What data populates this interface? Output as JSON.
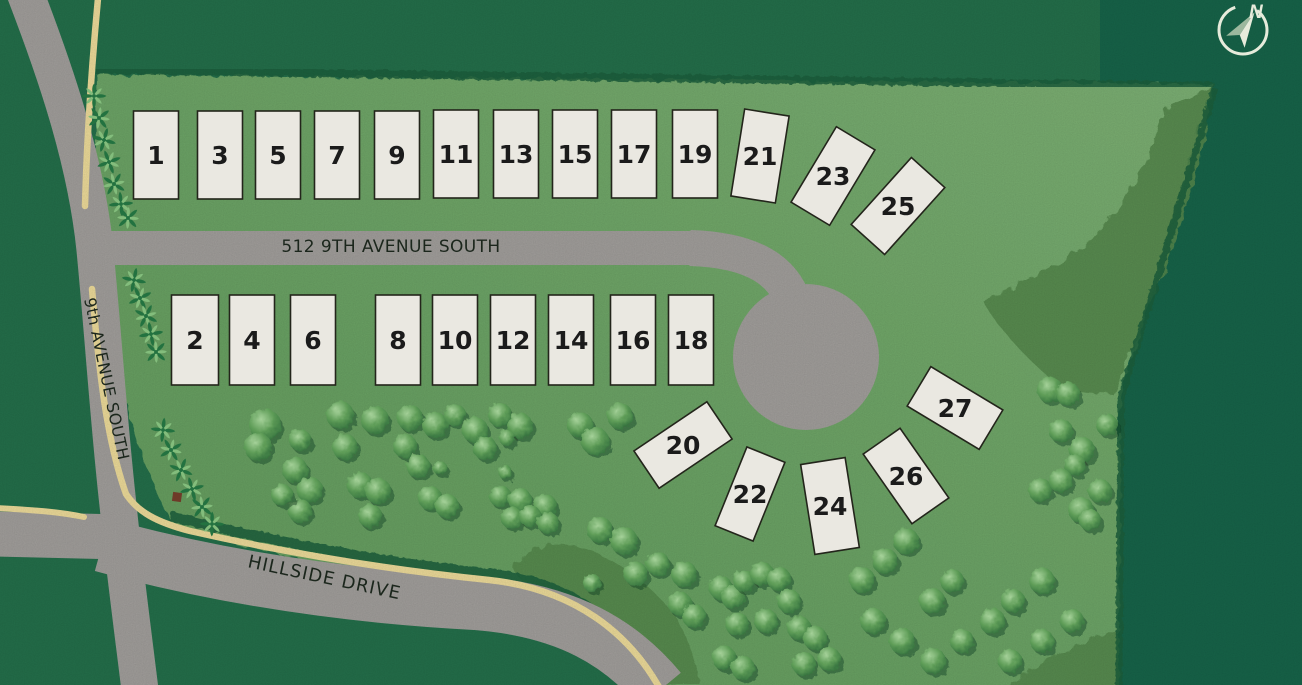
{
  "map_title": "Residential lot site plan",
  "colors": {
    "bg_dark": "#24704b",
    "bg_dark2": "#17654a",
    "parcel_dark": "#639c5e",
    "parcel_mid": "#6fa768",
    "parcel_light": "#7eb275",
    "swale": "#56894e",
    "road": "#a3a09d",
    "stripe": "#efdd9b",
    "lot_fill": "#eae8e1",
    "lot_border": "#23251b",
    "lot_number": "#1b1b1b",
    "street_label": "#1e2a1f",
    "fringe": "#1d603c",
    "tree_light": "#a6d29a",
    "tree_mid": "#5f9d58",
    "tree_dark": "#2e6b3a",
    "palm_dark": "#237240",
    "palm_light": "#83bd7c",
    "compass": "#e6ebdb",
    "compass_muted": "#9cb89e",
    "marker": "#6e3a28"
  },
  "streets": {
    "main": {
      "label": "512 9TH AVENUE SOUTH"
    },
    "ninth": {
      "label": "9th AVENUE SOUTH"
    },
    "hillside": {
      "label": "HILLSIDE DRIVE"
    }
  },
  "compass": {
    "label": "N"
  },
  "lots": {
    "default_w": 45,
    "default_h": 88,
    "items": [
      {
        "n": "1",
        "x": 156,
        "y": 155
      },
      {
        "n": "3",
        "x": 220,
        "y": 155
      },
      {
        "n": "5",
        "x": 278,
        "y": 155
      },
      {
        "n": "7",
        "x": 337,
        "y": 155
      },
      {
        "n": "9",
        "x": 397,
        "y": 155
      },
      {
        "n": "11",
        "x": 456,
        "y": 154
      },
      {
        "n": "13",
        "x": 516,
        "y": 154
      },
      {
        "n": "15",
        "x": 575,
        "y": 154
      },
      {
        "n": "17",
        "x": 634,
        "y": 154
      },
      {
        "n": "19",
        "x": 695,
        "y": 154
      },
      {
        "n": "21",
        "x": 760,
        "y": 156,
        "r": 9
      },
      {
        "n": "23",
        "x": 833,
        "y": 176,
        "r": 31
      },
      {
        "n": "25",
        "x": 898,
        "y": 206,
        "r": 42,
        "h": 90
      },
      {
        "n": "2",
        "x": 195,
        "y": 340,
        "w": 47,
        "h": 90
      },
      {
        "n": "4",
        "x": 252,
        "y": 340,
        "h": 90
      },
      {
        "n": "6",
        "x": 313,
        "y": 340,
        "h": 90
      },
      {
        "n": "8",
        "x": 398,
        "y": 340,
        "h": 90
      },
      {
        "n": "10",
        "x": 455,
        "y": 340,
        "h": 90
      },
      {
        "n": "12",
        "x": 513,
        "y": 340,
        "h": 90
      },
      {
        "n": "14",
        "x": 571,
        "y": 340,
        "h": 90
      },
      {
        "n": "16",
        "x": 633,
        "y": 340,
        "h": 90
      },
      {
        "n": "18",
        "x": 691,
        "y": 340,
        "h": 90
      },
      {
        "n": "20",
        "x": 683,
        "y": 445,
        "r": 56
      },
      {
        "n": "22",
        "x": 750,
        "y": 494,
        "r": 22,
        "w": 41,
        "h": 85
      },
      {
        "n": "24",
        "x": 830,
        "y": 506,
        "r": -9,
        "h": 91
      },
      {
        "n": "26",
        "x": 906,
        "y": 476,
        "r": -35,
        "h": 85
      },
      {
        "n": "27",
        "x": 955,
        "y": 408,
        "r": -59,
        "w": 46,
        "h": 84
      }
    ]
  },
  "trees": [
    [
      265,
      425,
      16
    ],
    [
      258,
      447,
      14
    ],
    [
      300,
      440,
      11
    ],
    [
      340,
      415,
      14
    ],
    [
      375,
      420,
      14
    ],
    [
      345,
      447,
      13
    ],
    [
      410,
      418,
      13
    ],
    [
      435,
      425,
      13
    ],
    [
      405,
      446,
      12
    ],
    [
      455,
      415,
      11
    ],
    [
      475,
      430,
      13
    ],
    [
      500,
      415,
      12
    ],
    [
      520,
      426,
      13
    ],
    [
      580,
      425,
      13
    ],
    [
      595,
      441,
      14
    ],
    [
      620,
      416,
      13
    ],
    [
      507,
      438,
      8
    ],
    [
      485,
      448,
      12
    ],
    [
      295,
      470,
      13
    ],
    [
      310,
      490,
      13
    ],
    [
      300,
      511,
      12
    ],
    [
      282,
      495,
      11
    ],
    [
      360,
      485,
      13
    ],
    [
      378,
      491,
      13
    ],
    [
      370,
      516,
      12
    ],
    [
      418,
      466,
      12
    ],
    [
      430,
      498,
      12
    ],
    [
      447,
      506,
      12
    ],
    [
      440,
      468,
      7
    ],
    [
      505,
      472,
      7
    ],
    [
      500,
      496,
      11
    ],
    [
      520,
      500,
      12
    ],
    [
      545,
      506,
      12
    ],
    [
      512,
      518,
      11
    ],
    [
      530,
      516,
      11
    ],
    [
      548,
      523,
      11
    ],
    [
      600,
      530,
      13
    ],
    [
      624,
      541,
      14
    ],
    [
      636,
      574,
      12
    ],
    [
      658,
      564,
      12
    ],
    [
      684,
      574,
      13
    ],
    [
      592,
      583,
      9
    ],
    [
      680,
      604,
      12
    ],
    [
      694,
      616,
      12
    ],
    [
      721,
      588,
      12
    ],
    [
      733,
      597,
      12
    ],
    [
      744,
      581,
      11
    ],
    [
      762,
      574,
      12
    ],
    [
      779,
      579,
      12
    ],
    [
      789,
      601,
      12
    ],
    [
      737,
      624,
      12
    ],
    [
      724,
      658,
      12
    ],
    [
      743,
      668,
      12
    ],
    [
      766,
      621,
      12
    ],
    [
      799,
      628,
      12
    ],
    [
      815,
      638,
      12
    ],
    [
      804,
      664,
      12
    ],
    [
      829,
      659,
      12
    ],
    [
      862,
      580,
      13
    ],
    [
      885,
      561,
      13
    ],
    [
      906,
      541,
      13
    ],
    [
      873,
      621,
      13
    ],
    [
      902,
      641,
      13
    ],
    [
      932,
      601,
      13
    ],
    [
      952,
      581,
      12
    ],
    [
      933,
      661,
      13
    ],
    [
      962,
      641,
      12
    ],
    [
      992,
      621,
      13
    ],
    [
      1013,
      601,
      12
    ],
    [
      1042,
      581,
      13
    ],
    [
      1010,
      661,
      12
    ],
    [
      1042,
      641,
      12
    ],
    [
      1072,
      621,
      12
    ],
    [
      1050,
      390,
      13
    ],
    [
      1068,
      394,
      12
    ],
    [
      1061,
      431,
      12
    ],
    [
      1082,
      450,
      13
    ],
    [
      1075,
      465,
      11
    ],
    [
      1040,
      490,
      12
    ],
    [
      1061,
      481,
      12
    ],
    [
      1081,
      510,
      13
    ],
    [
      1100,
      491,
      12
    ],
    [
      1090,
      520,
      11
    ],
    [
      1107,
      425,
      11
    ]
  ],
  "palms": [
    [
      94,
      96
    ],
    [
      99,
      118
    ],
    [
      104,
      140
    ],
    [
      109,
      162
    ],
    [
      114,
      184
    ],
    [
      121,
      204
    ],
    [
      128,
      218
    ],
    [
      134,
      280
    ],
    [
      140,
      298
    ],
    [
      146,
      316
    ],
    [
      151,
      334
    ],
    [
      156,
      352
    ],
    [
      163,
      430
    ],
    [
      171,
      450
    ],
    [
      181,
      470
    ],
    [
      192,
      489
    ],
    [
      202,
      507
    ],
    [
      212,
      524
    ]
  ],
  "marker": {
    "x": 177,
    "y": 497,
    "size": 9
  }
}
